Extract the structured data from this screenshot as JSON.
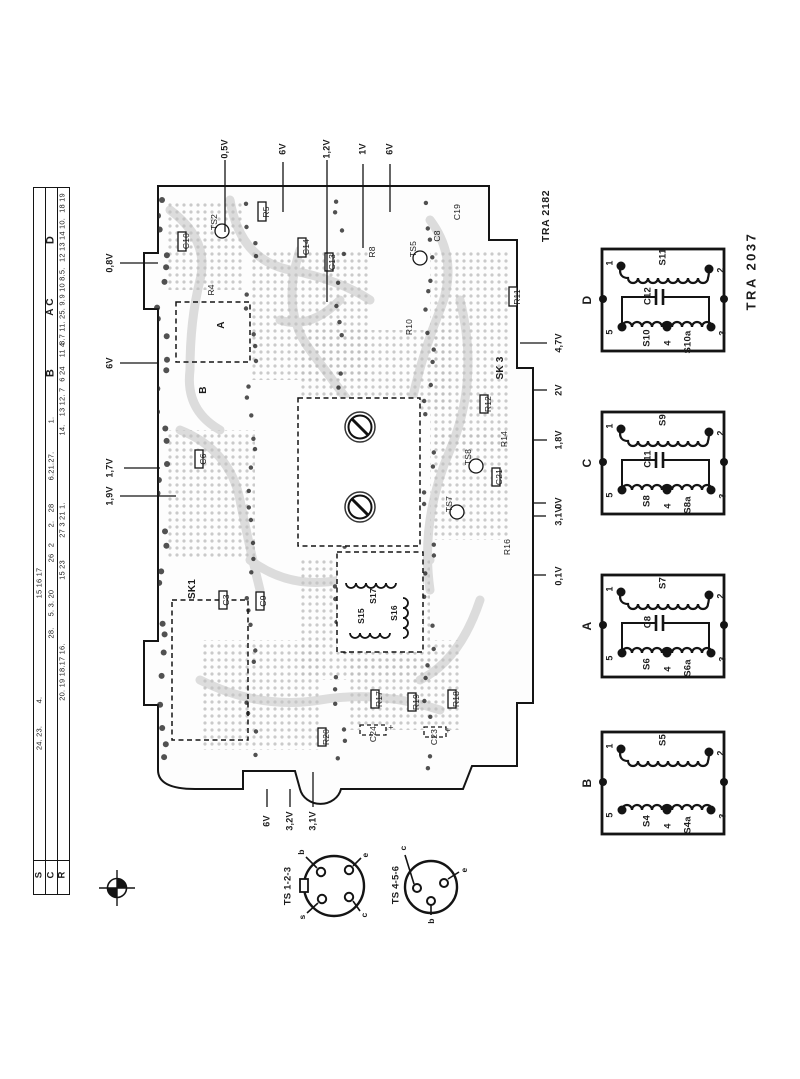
{
  "titles": {
    "pcb": "TRA 2182",
    "transformers": "TRA 2037"
  },
  "ruler": {
    "rows": [
      {
        "key": "S",
        "items": [
          {
            "t": "15 16 17",
            "y": 583
          },
          {
            "t": "4.",
            "y": 700
          },
          {
            "t": "24. 23.",
            "y": 738
          }
        ]
      },
      {
        "key": "C",
        "items": [
          {
            "t": "D",
            "y": 240,
            "s": 11,
            "b": 1
          },
          {
            "t": "A C",
            "y": 307,
            "s": 10,
            "b": 1
          },
          {
            "t": "B",
            "y": 373,
            "s": 11,
            "b": 1
          },
          {
            "t": "1.",
            "y": 420
          },
          {
            "t": "6.21.27.",
            "y": 466
          },
          {
            "t": "28",
            "y": 508
          },
          {
            "t": "2.",
            "y": 524
          },
          {
            "t": "2",
            "y": 545
          },
          {
            "t": "26",
            "y": 558
          },
          {
            "t": "5. 3. 20",
            "y": 603
          },
          {
            "t": "28.",
            "y": 633
          }
        ]
      },
      {
        "key": "R",
        "items": [
          {
            "t": "18 19",
            "y": 203
          },
          {
            "t": "12 13 14 10.",
            "y": 240
          },
          {
            "t": "9 10 8.5.",
            "y": 283
          },
          {
            "t": "8.7 11. 25. 9.",
            "y": 322
          },
          {
            "t": "11 4",
            "y": 350
          },
          {
            "t": "6 24",
            "y": 374
          },
          {
            "t": "13 12. 7",
            "y": 402
          },
          {
            "t": "14.",
            "y": 430
          },
          {
            "t": "27 3 21 1.",
            "y": 520
          },
          {
            "t": "15 23",
            "y": 570
          },
          {
            "t": "20. 19 18.17 16.",
            "y": 672
          }
        ]
      }
    ]
  },
  "pcb": {
    "voltages_top": [
      {
        "t": "0,5V",
        "x": 225
      },
      {
        "t": "6V",
        "x": 283
      },
      {
        "t": "1,2V",
        "x": 327
      },
      {
        "t": "1V",
        "x": 363
      },
      {
        "t": "6V",
        "x": 390
      }
    ],
    "voltages_left": [
      {
        "t": "0,8V",
        "y": 263
      },
      {
        "t": "6V",
        "y": 363
      },
      {
        "t": "1,7V",
        "y": 468
      },
      {
        "t": "1,9V",
        "y": 496
      }
    ],
    "voltages_right": [
      {
        "t": "4,7V",
        "y": 343
      },
      {
        "t": "2V",
        "y": 390
      },
      {
        "t": "1,8V",
        "y": 440
      },
      {
        "t": "0V",
        "y": 503
      },
      {
        "t": "3,1V",
        "y": 516
      },
      {
        "t": "0,1V",
        "y": 576
      }
    ],
    "voltages_bottom": [
      {
        "t": "6V",
        "x": 267
      },
      {
        "t": "3,2V",
        "x": 290
      },
      {
        "t": "3,1V",
        "x": 313
      }
    ],
    "components": [
      {
        "t": "C10",
        "x": 186,
        "y": 241
      },
      {
        "t": "TS2",
        "x": 214,
        "y": 222
      },
      {
        "t": "R5",
        "x": 266,
        "y": 212
      },
      {
        "t": "C14",
        "x": 306,
        "y": 247
      },
      {
        "t": "C13",
        "x": 332,
        "y": 262
      },
      {
        "t": "R8",
        "x": 372,
        "y": 252
      },
      {
        "t": "TS5",
        "x": 413,
        "y": 249
      },
      {
        "t": "C8",
        "x": 437,
        "y": 236
      },
      {
        "t": "C19",
        "x": 457,
        "y": 212
      },
      {
        "t": "R4",
        "x": 211,
        "y": 290
      },
      {
        "t": "A",
        "x": 222,
        "y": 325,
        "s": 10,
        "b": 1
      },
      {
        "t": "B",
        "x": 204,
        "y": 390,
        "s": 10,
        "b": 1
      },
      {
        "t": "R11",
        "x": 517,
        "y": 297
      },
      {
        "t": "SK 3",
        "x": 501,
        "y": 368,
        "s": 10,
        "b": 1
      },
      {
        "t": "R12",
        "x": 488,
        "y": 404
      },
      {
        "t": "R14",
        "x": 504,
        "y": 439
      },
      {
        "t": "C21",
        "x": 499,
        "y": 477
      },
      {
        "t": "TS8",
        "x": 468,
        "y": 457
      },
      {
        "t": "TS7",
        "x": 449,
        "y": 504
      },
      {
        "t": "R16",
        "x": 507,
        "y": 547
      },
      {
        "t": "R10",
        "x": 409,
        "y": 327
      },
      {
        "t": "C6",
        "x": 203,
        "y": 459
      },
      {
        "t": "SK1",
        "x": 193,
        "y": 589,
        "s": 10,
        "b": 1
      },
      {
        "t": "C3",
        "x": 226,
        "y": 600
      },
      {
        "t": "C9",
        "x": 263,
        "y": 601
      },
      {
        "t": "S17",
        "x": 373,
        "y": 596,
        "b": 1
      },
      {
        "t": "S15",
        "x": 361,
        "y": 616,
        "b": 1
      },
      {
        "t": "S16",
        "x": 394,
        "y": 613,
        "b": 1
      },
      {
        "t": "R17",
        "x": 379,
        "y": 699
      },
      {
        "t": "R19",
        "x": 416,
        "y": 702
      },
      {
        "t": "R18",
        "x": 456,
        "y": 699
      },
      {
        "t": "R20",
        "x": 326,
        "y": 737
      },
      {
        "t": "C24",
        "x": 373,
        "y": 734
      },
      {
        "t": "C23",
        "x": 434,
        "y": 737
      },
      {
        "t": "+",
        "x": 391,
        "y": 728,
        "rot0": 1,
        "s": 9
      },
      {
        "t": "+",
        "x": 448,
        "y": 731,
        "rot0": 1,
        "s": 9
      }
    ]
  },
  "transformers": {
    "boxes": [
      {
        "letter": "D",
        "y": 247,
        "top_coil": "S11",
        "cap": "C12",
        "bottom_left": "S10",
        "bottom_right": "S10a",
        "pins": [
          "1",
          "2",
          "5",
          "4",
          "3"
        ]
      },
      {
        "letter": "C",
        "y": 410,
        "top_coil": "S9",
        "cap": "C11",
        "bottom_left": "S8",
        "bottom_right": "S8a",
        "pins": [
          "1",
          "2",
          "5",
          "4",
          "3"
        ]
      },
      {
        "letter": "A",
        "y": 573,
        "top_coil": "S7",
        "cap": "C8",
        "bottom_left": "S6",
        "bottom_right": "S6a",
        "pins": [
          "1",
          "2",
          "5",
          "4",
          "3"
        ]
      },
      {
        "letter": "B",
        "y": 730,
        "top_coil": "S5",
        "cap": null,
        "bottom_left": "S4",
        "bottom_right": "S4a",
        "pins": [
          "1",
          "2",
          "5",
          "4",
          "3"
        ]
      }
    ]
  },
  "connectors": [
    {
      "label": "TS 1-2-3",
      "lx": 288,
      "ly": 886,
      "pins": [
        {
          "t": "b",
          "x": 301,
          "y": 852
        },
        {
          "t": "e",
          "x": 365,
          "y": 855
        },
        {
          "t": "s",
          "x": 302,
          "y": 917
        },
        {
          "t": "c",
          "x": 364,
          "y": 915
        }
      ]
    },
    {
      "label": "TS 4-5-6",
      "lx": 396,
      "ly": 885,
      "pins": [
        {
          "t": "c",
          "x": 403,
          "y": 848
        },
        {
          "t": "e",
          "x": 464,
          "y": 870
        },
        {
          "t": "b",
          "x": 431,
          "y": 921
        }
      ]
    }
  ]
}
